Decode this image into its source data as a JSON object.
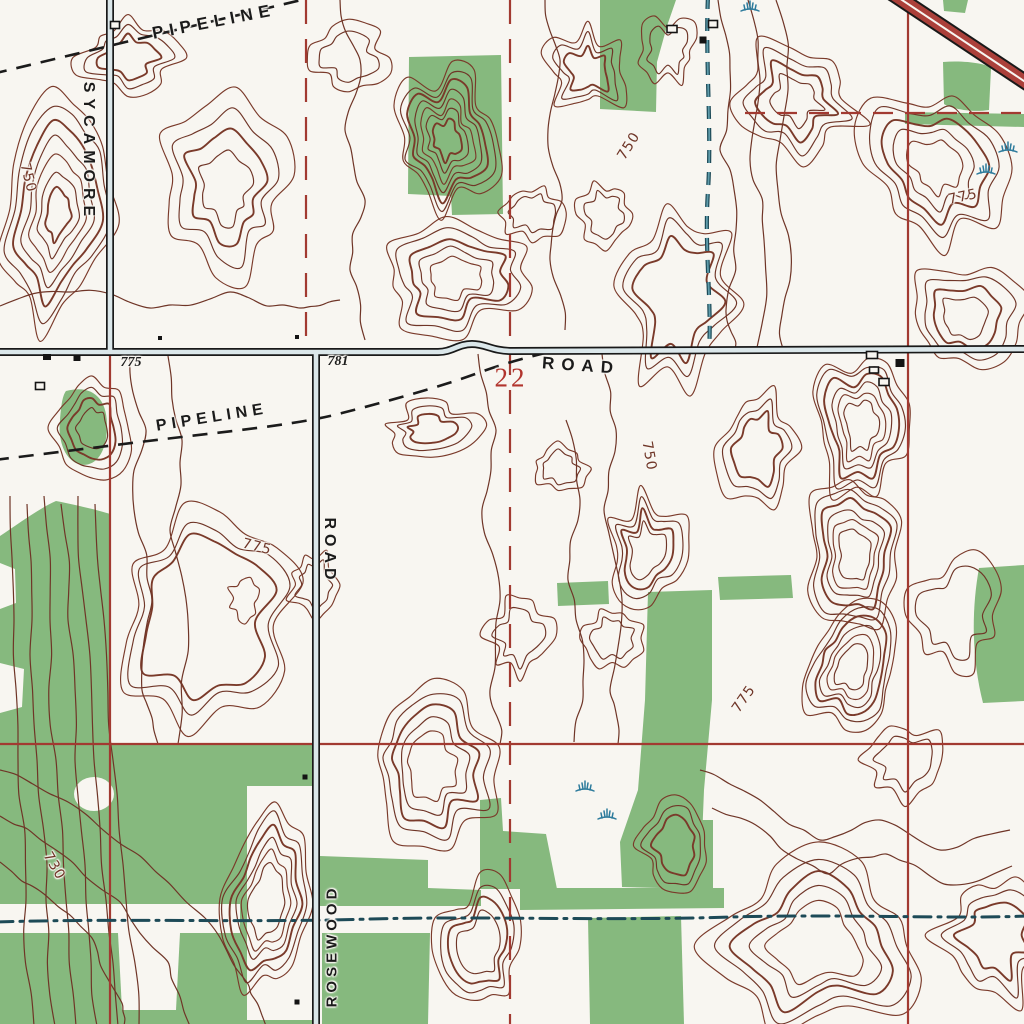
{
  "map": {
    "title": "USGS topographic quadrangle excerpt",
    "colors": {
      "paper": "#f8f6f1",
      "contour": "#6f3527",
      "contour_alt": "#7a3a2a",
      "vegetation": "#86b97e",
      "grid_red": "#a23a31",
      "section_red": "#b2352e",
      "road_fill": "#dbe7ea",
      "highway_red": "#ab403a",
      "water_blue": "#2d7b9c",
      "stream_dark": "#1d4a57",
      "ink": "#1b1b1b"
    },
    "road_labels": [
      {
        "id": "sycamore",
        "text": "SYCAMORE",
        "x": 88,
        "y": 152,
        "rotation": 90,
        "size": 16,
        "ls": 6
      },
      {
        "id": "road-east",
        "text": "ROAD",
        "x": 581,
        "y": 366,
        "rotation": 4,
        "size": 17,
        "ls": 7
      },
      {
        "id": "road-south",
        "text": "ROAD",
        "x": 329,
        "y": 551,
        "rotation": 90,
        "size": 16,
        "ls": 5
      },
      {
        "id": "rosewood",
        "text": "ROSEWOOD",
        "x": 332,
        "y": 946,
        "rotation": -90,
        "size": 15,
        "ls": 4
      }
    ],
    "pipeline_labels": [
      {
        "id": "pipeline-top",
        "text": "PIPELINE",
        "x": 214,
        "y": 22,
        "rotation": -11,
        "size": 17,
        "ls": 6
      },
      {
        "id": "pipeline-mid",
        "text": "PIPELINE",
        "x": 212,
        "y": 418,
        "rotation": -9,
        "size": 16,
        "ls": 5
      }
    ],
    "contour_labels": [
      {
        "text": "750",
        "x": 28,
        "y": 178,
        "rotation": 76
      },
      {
        "text": "750",
        "x": 629,
        "y": 146,
        "rotation": -58
      },
      {
        "text": "775",
        "x": 963,
        "y": 197,
        "rotation": -12
      },
      {
        "text": "775",
        "x": 257,
        "y": 547,
        "rotation": 14
      },
      {
        "text": "750",
        "x": 649,
        "y": 456,
        "rotation": 80
      },
      {
        "text": "775",
        "x": 744,
        "y": 699,
        "rotation": -55
      },
      {
        "text": "730",
        "x": 54,
        "y": 866,
        "rotation": 60
      }
    ],
    "spot_elevations": [
      {
        "text": "775",
        "x": 131,
        "y": 363
      },
      {
        "text": "781",
        "x": 338,
        "y": 362
      }
    ],
    "section_number": {
      "text": "22",
      "x": 511,
      "y": 378,
      "size": 27
    },
    "buildings_solid": [
      [
        703,
        40,
        7,
        7
      ],
      [
        47,
        357,
        8,
        6
      ],
      [
        77,
        358,
        7,
        6
      ],
      [
        900,
        363,
        9,
        8
      ],
      [
        305,
        777,
        5,
        5
      ],
      [
        297,
        1002,
        5,
        5
      ],
      [
        160,
        338,
        4,
        4
      ],
      [
        297,
        337,
        4,
        4
      ]
    ],
    "buildings_open": [
      [
        115,
        25,
        9,
        7
      ],
      [
        672,
        29,
        10,
        7
      ],
      [
        713,
        24,
        9,
        7
      ],
      [
        40,
        386,
        9,
        7
      ],
      [
        872,
        355,
        11,
        7
      ],
      [
        874,
        370,
        9,
        6
      ],
      [
        884,
        382,
        10,
        7
      ]
    ],
    "marsh_symbols": [
      [
        750,
        6
      ],
      [
        1008,
        147
      ],
      [
        986,
        169
      ],
      [
        585,
        786
      ],
      [
        607,
        814
      ]
    ]
  }
}
